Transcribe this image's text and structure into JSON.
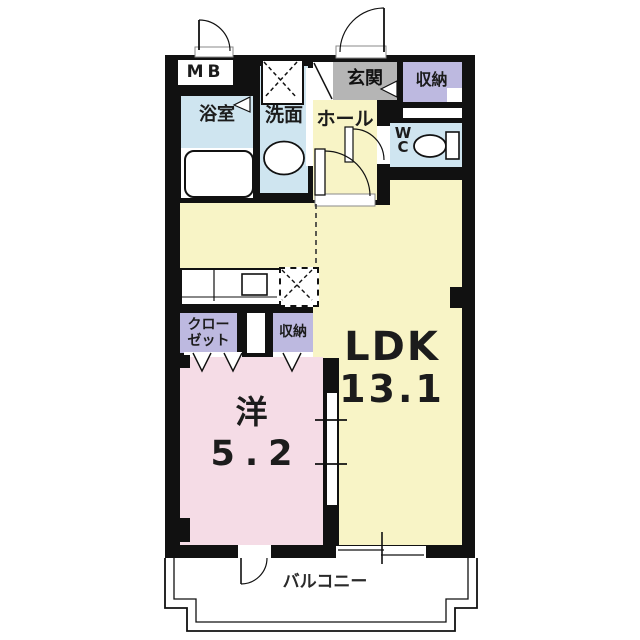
{
  "plan": {
    "labels": {
      "mb": "MB",
      "bathroom": "浴室",
      "washroom": "洗面",
      "entrance": "玄関",
      "storage_top": "収納",
      "hall": "ホール",
      "wc_line1": "W",
      "wc_line2": "C",
      "ldk_name": "LDK",
      "ldk_area": "13.1",
      "closet_line1": "クロー",
      "closet_line2": "ゼット",
      "storage_mid": "収納",
      "western_name": "洋",
      "western_area": "5.2",
      "balcony": "バルコニー"
    },
    "fixtures": [
      "bathtub",
      "washbasin",
      "washing-machine-space",
      "toilet",
      "kitchen-counter",
      "sink",
      "refrigerator-space"
    ],
    "colors": {
      "wall": "#111111",
      "water_rooms": "#cfe5f0",
      "living_rooms": "#f8f4c6",
      "storage_rooms": "#bdb9e0",
      "entrance_gray": "#b5b5b5",
      "bedroom_pink": "#f5dce6",
      "background": "#ffffff"
    }
  }
}
